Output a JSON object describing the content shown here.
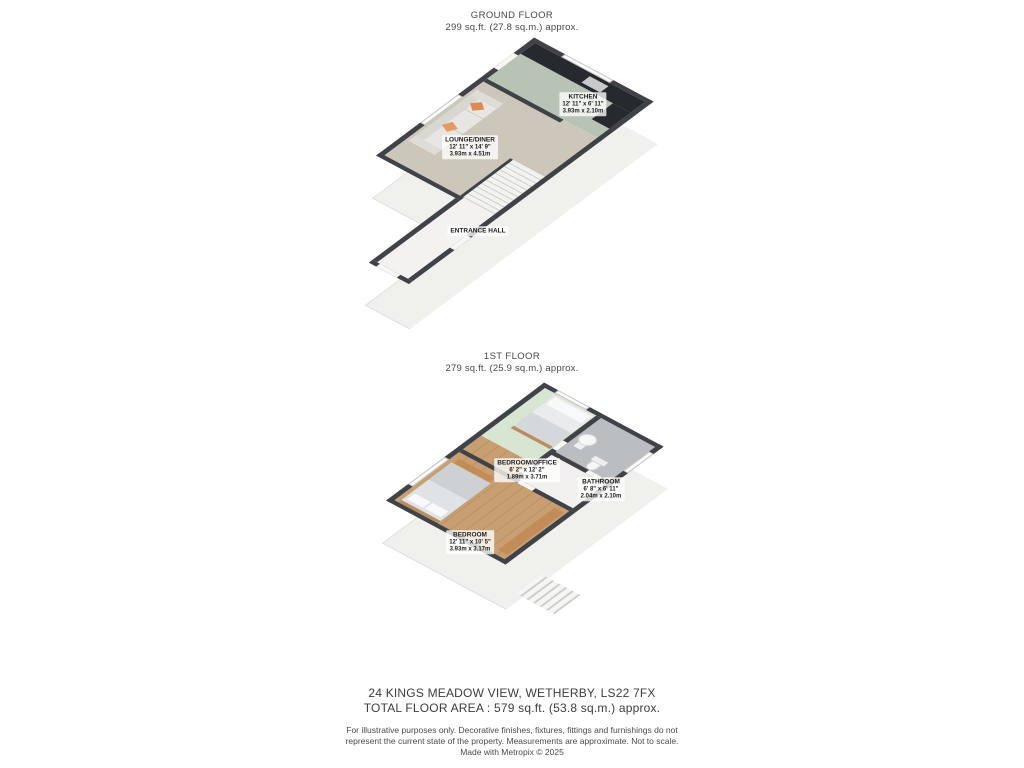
{
  "floors": [
    {
      "title": "GROUND FLOOR",
      "area": "299 sq.ft. (27.8 sq.m.) approx.",
      "rooms": [
        {
          "name": "KITCHEN",
          "dims_imperial": "12' 11\" x 6' 11\"",
          "dims_metric": "3.93m x 2.10m"
        },
        {
          "name": "LOUNGE/DINER",
          "dims_imperial": "12' 11\" x 14' 9\"",
          "dims_metric": "3.93m x 4.51m"
        },
        {
          "name": "ENTRANCE HALL",
          "dims_imperial": "",
          "dims_metric": ""
        }
      ]
    },
    {
      "title": "1ST FLOOR",
      "area": "279 sq.ft. (25.9 sq.m.) approx.",
      "rooms": [
        {
          "name": "BEDROOM/OFFICE",
          "dims_imperial": "6' 2\" x 12' 2\"",
          "dims_metric": "1.89m x 3.71m"
        },
        {
          "name": "BATHROOM",
          "dims_imperial": "6' 8\" x 6' 11\"",
          "dims_metric": "2.04m x 2.10m"
        },
        {
          "name": "BEDROOM",
          "dims_imperial": "12' 11\" x 10' 5\"",
          "dims_metric": "3.93m x 3.17m"
        }
      ]
    }
  ],
  "footer": {
    "address": "24 KINGS MEADOW VIEW, WETHERBY, LS22 7FX",
    "total_area": "TOTAL FLOOR AREA : 579 sq.ft. (53.8 sq.m.) approx.",
    "disclaimer_line1": "For illustrative purposes only. Decorative finishes, fixtures, fittings and furnishings do not",
    "disclaimer_line2": "represent the current state of the property. Measurements are approximate. Not to scale.",
    "disclaimer_line3": "Made with Metropix © 2025"
  },
  "colors": {
    "wall_top": "#3f4247",
    "kitchen_floor": "#b8c3b5",
    "lounge_floor": "#cdc7bb",
    "wood_floor": "#c89f72",
    "bathroom_floor": "#babec1",
    "office_floor": "#d8e5d2",
    "counter": "#26292d",
    "accent_pillow_orange": "#de8b51",
    "exterior_mass": "#f0f0ed"
  }
}
